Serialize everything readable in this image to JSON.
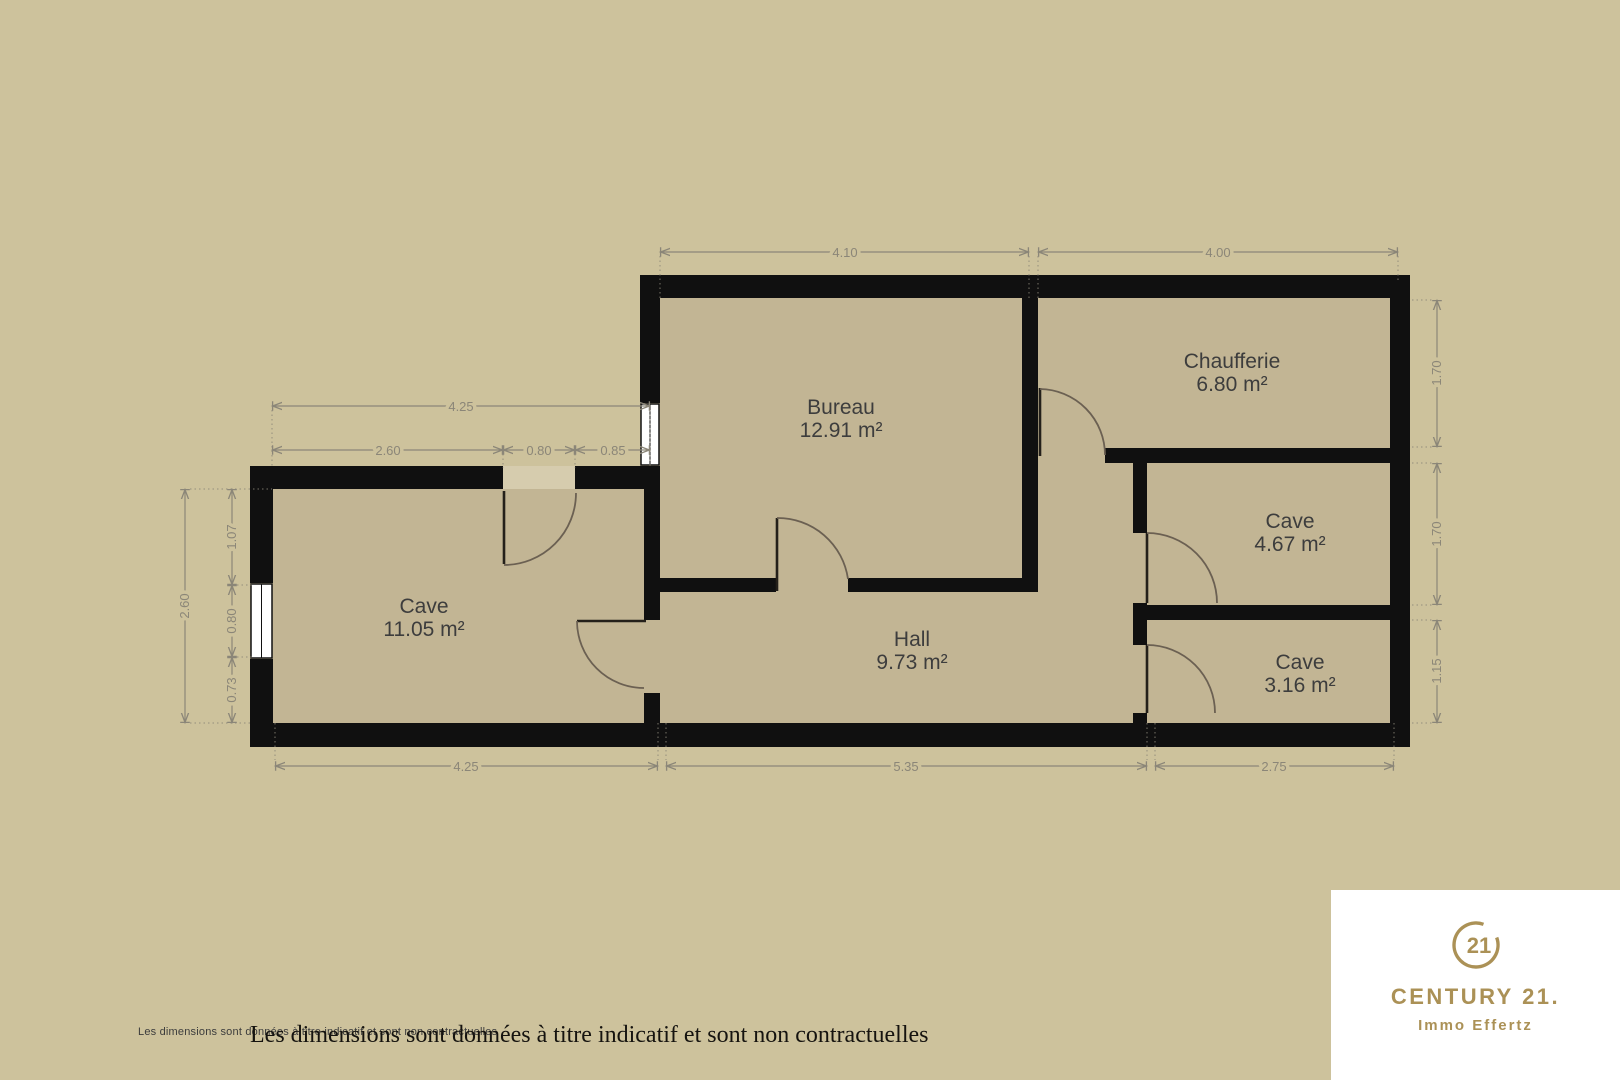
{
  "plan": {
    "rooms": [
      {
        "name": "Bureau",
        "area": "12.91 m²"
      },
      {
        "name": "Chaufferie",
        "area": "6.80 m²"
      },
      {
        "name": "Cave",
        "area": "11.05 m²"
      },
      {
        "name": "Hall",
        "area": "9.73 m²"
      },
      {
        "name": "Cave",
        "area": "4.67 m²"
      },
      {
        "name": "Cave",
        "area": "3.16 m²"
      }
    ],
    "dimensions": {
      "d410": "4.10",
      "d400": "4.00",
      "d425t": "4.25",
      "d260t": "2.60",
      "d080t": "0.80",
      "d085t": "0.85",
      "d260l": "2.60",
      "d107": "1.07",
      "d080l": "0.80",
      "d073": "0.73",
      "d170a": "1.70",
      "d170b": "1.70",
      "d115": "1.15",
      "d425b": "4.25",
      "d535": "5.35",
      "d275": "2.75"
    }
  },
  "disclaimer": {
    "small": "Les dimensions sont données à titre indicatif et sont non contractuelles",
    "large": "Les dimensions sont données à titre indicatif et sont non contractuelles"
  },
  "logo": {
    "number": "21",
    "brand": "CENTURY 21.",
    "agency": "Immo Effertz"
  },
  "colors": {
    "background": "#cdc29c",
    "floor": "#c2b594",
    "wall": "#101010",
    "threshold": "#d6ccae",
    "dimension": "#8b8678",
    "room_label": "#3d3d3d",
    "brand_gold": "#ab9156",
    "logo_panel": "#ffffff"
  }
}
